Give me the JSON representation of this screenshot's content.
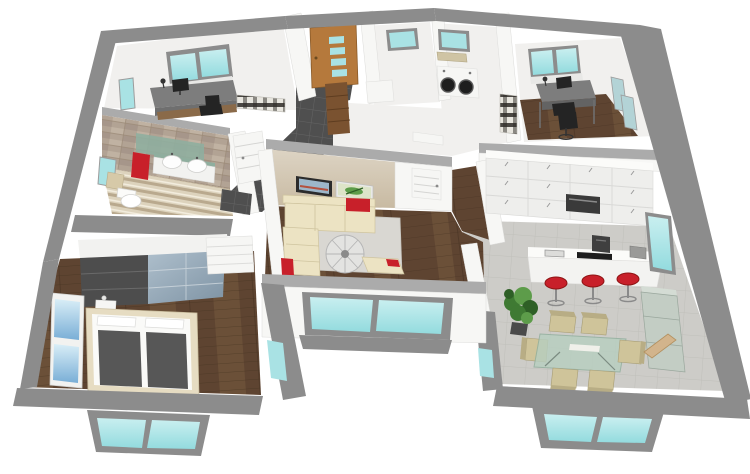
{
  "meta": {
    "description": "3D isometric cutaway rendering of a single-story house floor plan on a white background; no text labels visible",
    "view": "isometric cutaway from above",
    "background": "#ffffff"
  },
  "palette": {
    "wall": "#8c8c8c",
    "wallTop": "#ababab",
    "wallLight": "#f7f7f5",
    "floorWhite": "#f1f0ee",
    "glass": "#a9e2e4",
    "glassSky": "#8fc3dc",
    "walnut": "#5e4431",
    "walnutLight": "#6b5038",
    "walnutLine": "#42301f",
    "woodPanel": "#d5cbb8",
    "stone": "#b2a394",
    "stripeA": "#ddd3bd",
    "stripeB": "#b9a98e",
    "stripeC": "#f2ecdd",
    "cream": "#ece3c3",
    "creamEdge": "#cfc49f",
    "red": "#c8202a",
    "darkTile": "#4f4f4f",
    "charcoal": "#242424",
    "deskGray": "#7d7d7d",
    "cabinet": "#eeeeec",
    "tileFloor": "#cdccc8",
    "doorWood": "#b5793c",
    "cabinetWood": "#7a5230",
    "plantGreen": "#3f7a33",
    "plantLight": "#5d9c4a",
    "plantDark": "#2e5f26",
    "glassGreen": "#b7cfc0",
    "chairBeige": "#cfc49a",
    "chairBeigeEdge": "#a89e76",
    "wardrobeDark": "#4d4d4d",
    "wardrobeGlass": "#93a7b8",
    "duvet": "#575757",
    "mirrorGreen": "#8fae9e"
  },
  "scene": {
    "building": "house interior, gray perimeter walls, cyan glazing",
    "rooms": [
      {
        "id": "office-nw",
        "label": "office top-left",
        "items": [
          "roof window",
          "side window",
          "gray desk",
          "monitor",
          "desk lamp",
          "office chair",
          "plaid daybed"
        ]
      },
      {
        "id": "bathroom",
        "label": "bathroom",
        "items": [
          "stone accent wall",
          "green glass mirror",
          "red towel",
          "double vessel-sink vanity",
          "toilet",
          "bath mat",
          "striped tile floor",
          "window",
          "dark shower tile",
          "white door"
        ]
      },
      {
        "id": "entry",
        "label": "entry hall",
        "items": [
          "wooden front door with 4 glass panes",
          "tall wooden cabinet",
          "dark tile floor"
        ]
      },
      {
        "id": "wc",
        "label": "WC",
        "items": [
          "window",
          "white fixture"
        ]
      },
      {
        "id": "laundry",
        "label": "laundry room",
        "items": [
          "window",
          "mat",
          "washer",
          "dryer"
        ]
      },
      {
        "id": "office-ne",
        "label": "office top-right",
        "items": [
          "roof window",
          "side windows",
          "dark desk",
          "monitor",
          "desk lamp",
          "office chair",
          "plaid daybed",
          "walnut floor"
        ]
      },
      {
        "id": "kitchen",
        "label": "kitchen",
        "items": [
          "white cabinet wall",
          "built-in oven",
          "island with cooktop and sink",
          "coffee machine",
          "red bar stools",
          "tall window"
        ]
      },
      {
        "id": "dining",
        "label": "dining area",
        "items": [
          "glass dining table",
          "beige chairs",
          "potted plant",
          "glass sideboard",
          "wooden chair",
          "bay window",
          "tile floor"
        ]
      },
      {
        "id": "living",
        "label": "living room",
        "items": [
          "wood panel accent wall",
          "framed pictures",
          "cream corner sofa",
          "red cushions",
          "gray rug",
          "spiral staircase",
          "chaise lounge",
          "white interior doors",
          "walnut floor",
          "large patio window"
        ]
      },
      {
        "id": "bedroom",
        "label": "bedroom",
        "items": [
          "sliding wardrobe dark + glass doors",
          "double bed with gray duvets",
          "white nightstand",
          "white dresser",
          "tall sky window",
          "bay window",
          "walnut floor"
        ]
      },
      {
        "id": "hallway",
        "label": "hallway",
        "items": [
          "walnut floor",
          "white doors"
        ]
      }
    ],
    "counts": {
      "bar_stools": 3,
      "dining_chairs": 6,
      "wall_pictures": 2,
      "vanity_sinks": 2,
      "laundry_appliances": 2,
      "front_door_glass_panes": 4
    }
  }
}
